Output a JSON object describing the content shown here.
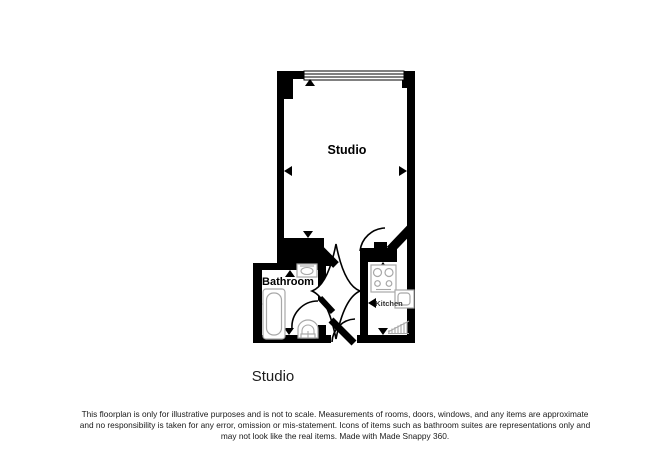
{
  "page": {
    "background": "#ffffff"
  },
  "floorplan": {
    "wall_color": "#000000",
    "fixture_color": "#a8a8a8",
    "rooms": [
      {
        "label": "Studio"
      },
      {
        "label": "Bathroom"
      },
      {
        "label": "Kitchen"
      }
    ],
    "icons": [
      "window-icon",
      "bathtub-icon",
      "bathroom-sink-icon",
      "toilet-icon",
      "hob-icon",
      "kitchen-sink-icon",
      "radiator-icon",
      "direction-marker-icon",
      "door-swing-icon"
    ]
  },
  "caption": {
    "text": "Studio"
  },
  "disclaimer": {
    "lines": [
      "This floorplan is only for illustrative purposes and is not to scale. Measurements of rooms, doors, windows, and any items are approximate",
      "and no responsibility is taken for any error, omission or mis-statement. Icons of items such as bathroom suites are representations only and",
      "may not look like the real items. Made with Made Snappy 360."
    ]
  }
}
